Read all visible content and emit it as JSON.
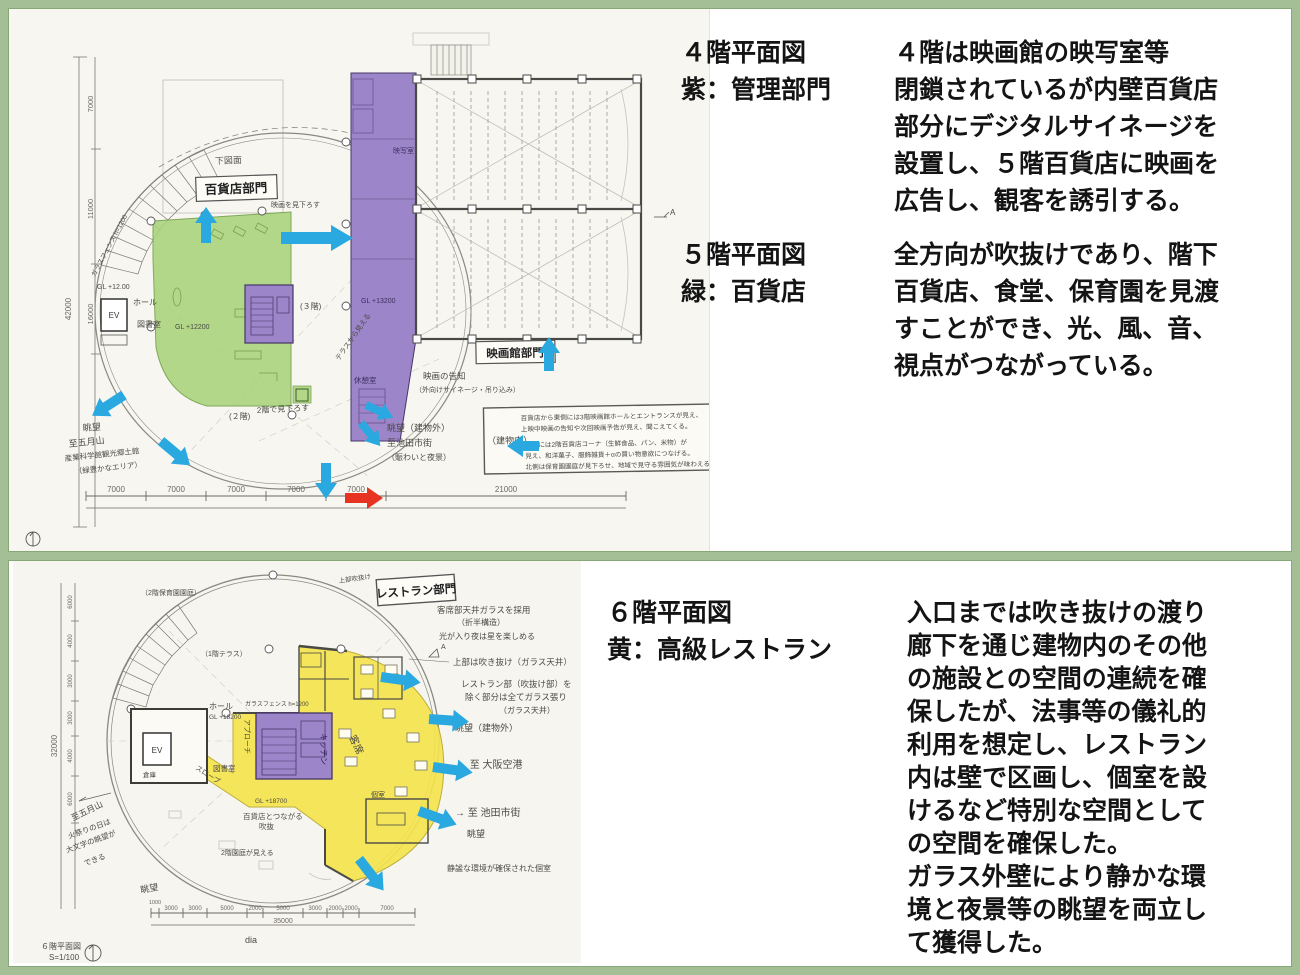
{
  "colors": {
    "frame_green": "#a4be96",
    "department_green": "#a9d37b",
    "management_purple": "#9d85c9",
    "restaurant_yellow": "#f4e44e",
    "arrow_blue": "#29a9e0",
    "arrow_red": "#e63322"
  },
  "panel_top": {
    "caption1": {
      "title1": "４階平面図",
      "title2": "紫：管理部門",
      "body": [
        "４階は映画館の映写室等",
        "閉鎖されているが内壁百貨店",
        "部分にデジタルサイネージを",
        "設置し、５階百貨店に映画を",
        "広告し、観客を誘引する。"
      ]
    },
    "caption2": {
      "title1": "５階平面図",
      "title2": "緑：百貨店",
      "body": [
        "全方向が吹抜けであり、階下",
        "百貨店、食堂、保育園を見渡",
        "すことができ、光、風、音、",
        "視点がつながっている。"
      ]
    },
    "drawing": {
      "box_labels": {
        "dept": "百貨店部門",
        "cinema": "映画館部門"
      },
      "rooms": {
        "ev": "EV",
        "hall": "ホール",
        "library": "図書室",
        "rest": "休憩室",
        "proj": "映写室",
        "gl_green": "GL +12200",
        "gl_hall": "GL +12.00",
        "gl_strip": "GL +13200",
        "floor3": "(３階)",
        "floor2": "(２階)",
        "lookdown": "2階で見下ろす",
        "terrace": "テラスから見える",
        "underlay": "下図面",
        "cinema_view": "映画を見下ろす",
        "glass_fence": "ガラスフェンス h=1200"
      },
      "west": {
        "view": "眺望",
        "to": "至五月山",
        "l2": "産業科学館観光郷土館",
        "l3": "（緑豊かなエリア）"
      },
      "east": {
        "view": "眺望（建物外）",
        "to": "至池田市街",
        "l2": "（賑わいと夜景）"
      },
      "signage": {
        "l1": "映画の告知",
        "l2": "（外向けサイネージ・吊り込み）"
      },
      "notebox": {
        "tag": "（建物内）",
        "l1": "百貨店から東側には3階映画館ホールとエントランスが見え、",
        "l2": "上映中映画の告知や次回映画予告が見え、聞こえてくる。",
        "l3": "南側には2階百貨店コーナ（生鮮食品、パン、米物）が",
        "l4": "見え、和洋菓子、服飾雑貨＋αの買い物意欲につなげる。",
        "l5": "北側は保育園園庭が見下ろせ、地域で見守る雰囲気が味わえる。"
      },
      "dims": {
        "d7": "7000",
        "d21": "21000",
        "left_total": "42000",
        "left_segs": [
          "7000",
          "11000",
          "16000"
        ]
      },
      "marker_a": "A"
    }
  },
  "panel_bottom": {
    "caption": {
      "title1": "６階平面図",
      "title2": "黄：高級レストラン",
      "body": [
        "入口までは吹き抜けの渡り",
        "廊下を通じ建物内のその他",
        "の施設との空間の連続を確",
        "保したが、法事等の儀礼的",
        "利用を想定し、レストラン",
        "内は壁で区画し、個室を設",
        "けるなど特別な空間として",
        "の空間を確保した。",
        "ガラス外壁により静かな環",
        "境と夜景等の眺望を両立し",
        "て獲得した。"
      ]
    },
    "drawing": {
      "box_label": "レストラン部門",
      "notes": {
        "ceiling1": "客席部天井ガラスを採用",
        "ceiling2": "（折半構造）",
        "ceiling3": "光が入り夜は星を楽しめる",
        "void1": "上部は吹き抜け（ガラス天井）",
        "void2": "レストラン部（吹抜け部）を",
        "void3": "除く部分は全てガラス張り",
        "void4": "（ガラス天井）",
        "view_out": "眺望（建物外）",
        "to_osaka": "→ 至 大阪空港",
        "to_ikeda": "→ 至 池田市街",
        "view": "眺望",
        "private_note": "静謐な環境が確保された個室",
        "top_void": "上部吹抜け",
        "nursery": "（2階保育園園庭）",
        "terrace1f": "（1階テラス）",
        "fence": "ガラスフェンス h=1200",
        "nursery_view": "2階園庭が見える",
        "void_link1": "百貨店とつながる",
        "void_link2": "吹抜"
      },
      "rooms": {
        "seats": "客席",
        "kitchen": "キッチン",
        "approach": "アプローチ",
        "slope": "スロープ",
        "gl": "GL +18700",
        "ev": "EV",
        "hall": "ホール",
        "hall_gl": "GL +18200",
        "store": "倉庫",
        "library": "図書室",
        "privroom": "個室",
        "view_sw": "眺望"
      },
      "west": {
        "to": "至五月山",
        "l2": "火祭りの日は",
        "l3": "大文字の眺望が",
        "l4": "できる"
      },
      "dims": {
        "segs": [
          "3000",
          "3000",
          "5000",
          "2000",
          "5000",
          "3000",
          "2000",
          "2000",
          "7000"
        ],
        "small": "1000",
        "total": "35000",
        "dia": "dia",
        "left_total": "32000",
        "left_segs": [
          "6000",
          "4000",
          "3000",
          "3000",
          "4000",
          "6000"
        ]
      },
      "scale1": "６階平面図",
      "scale2": "S=1/100",
      "marker_a": "A"
    }
  }
}
